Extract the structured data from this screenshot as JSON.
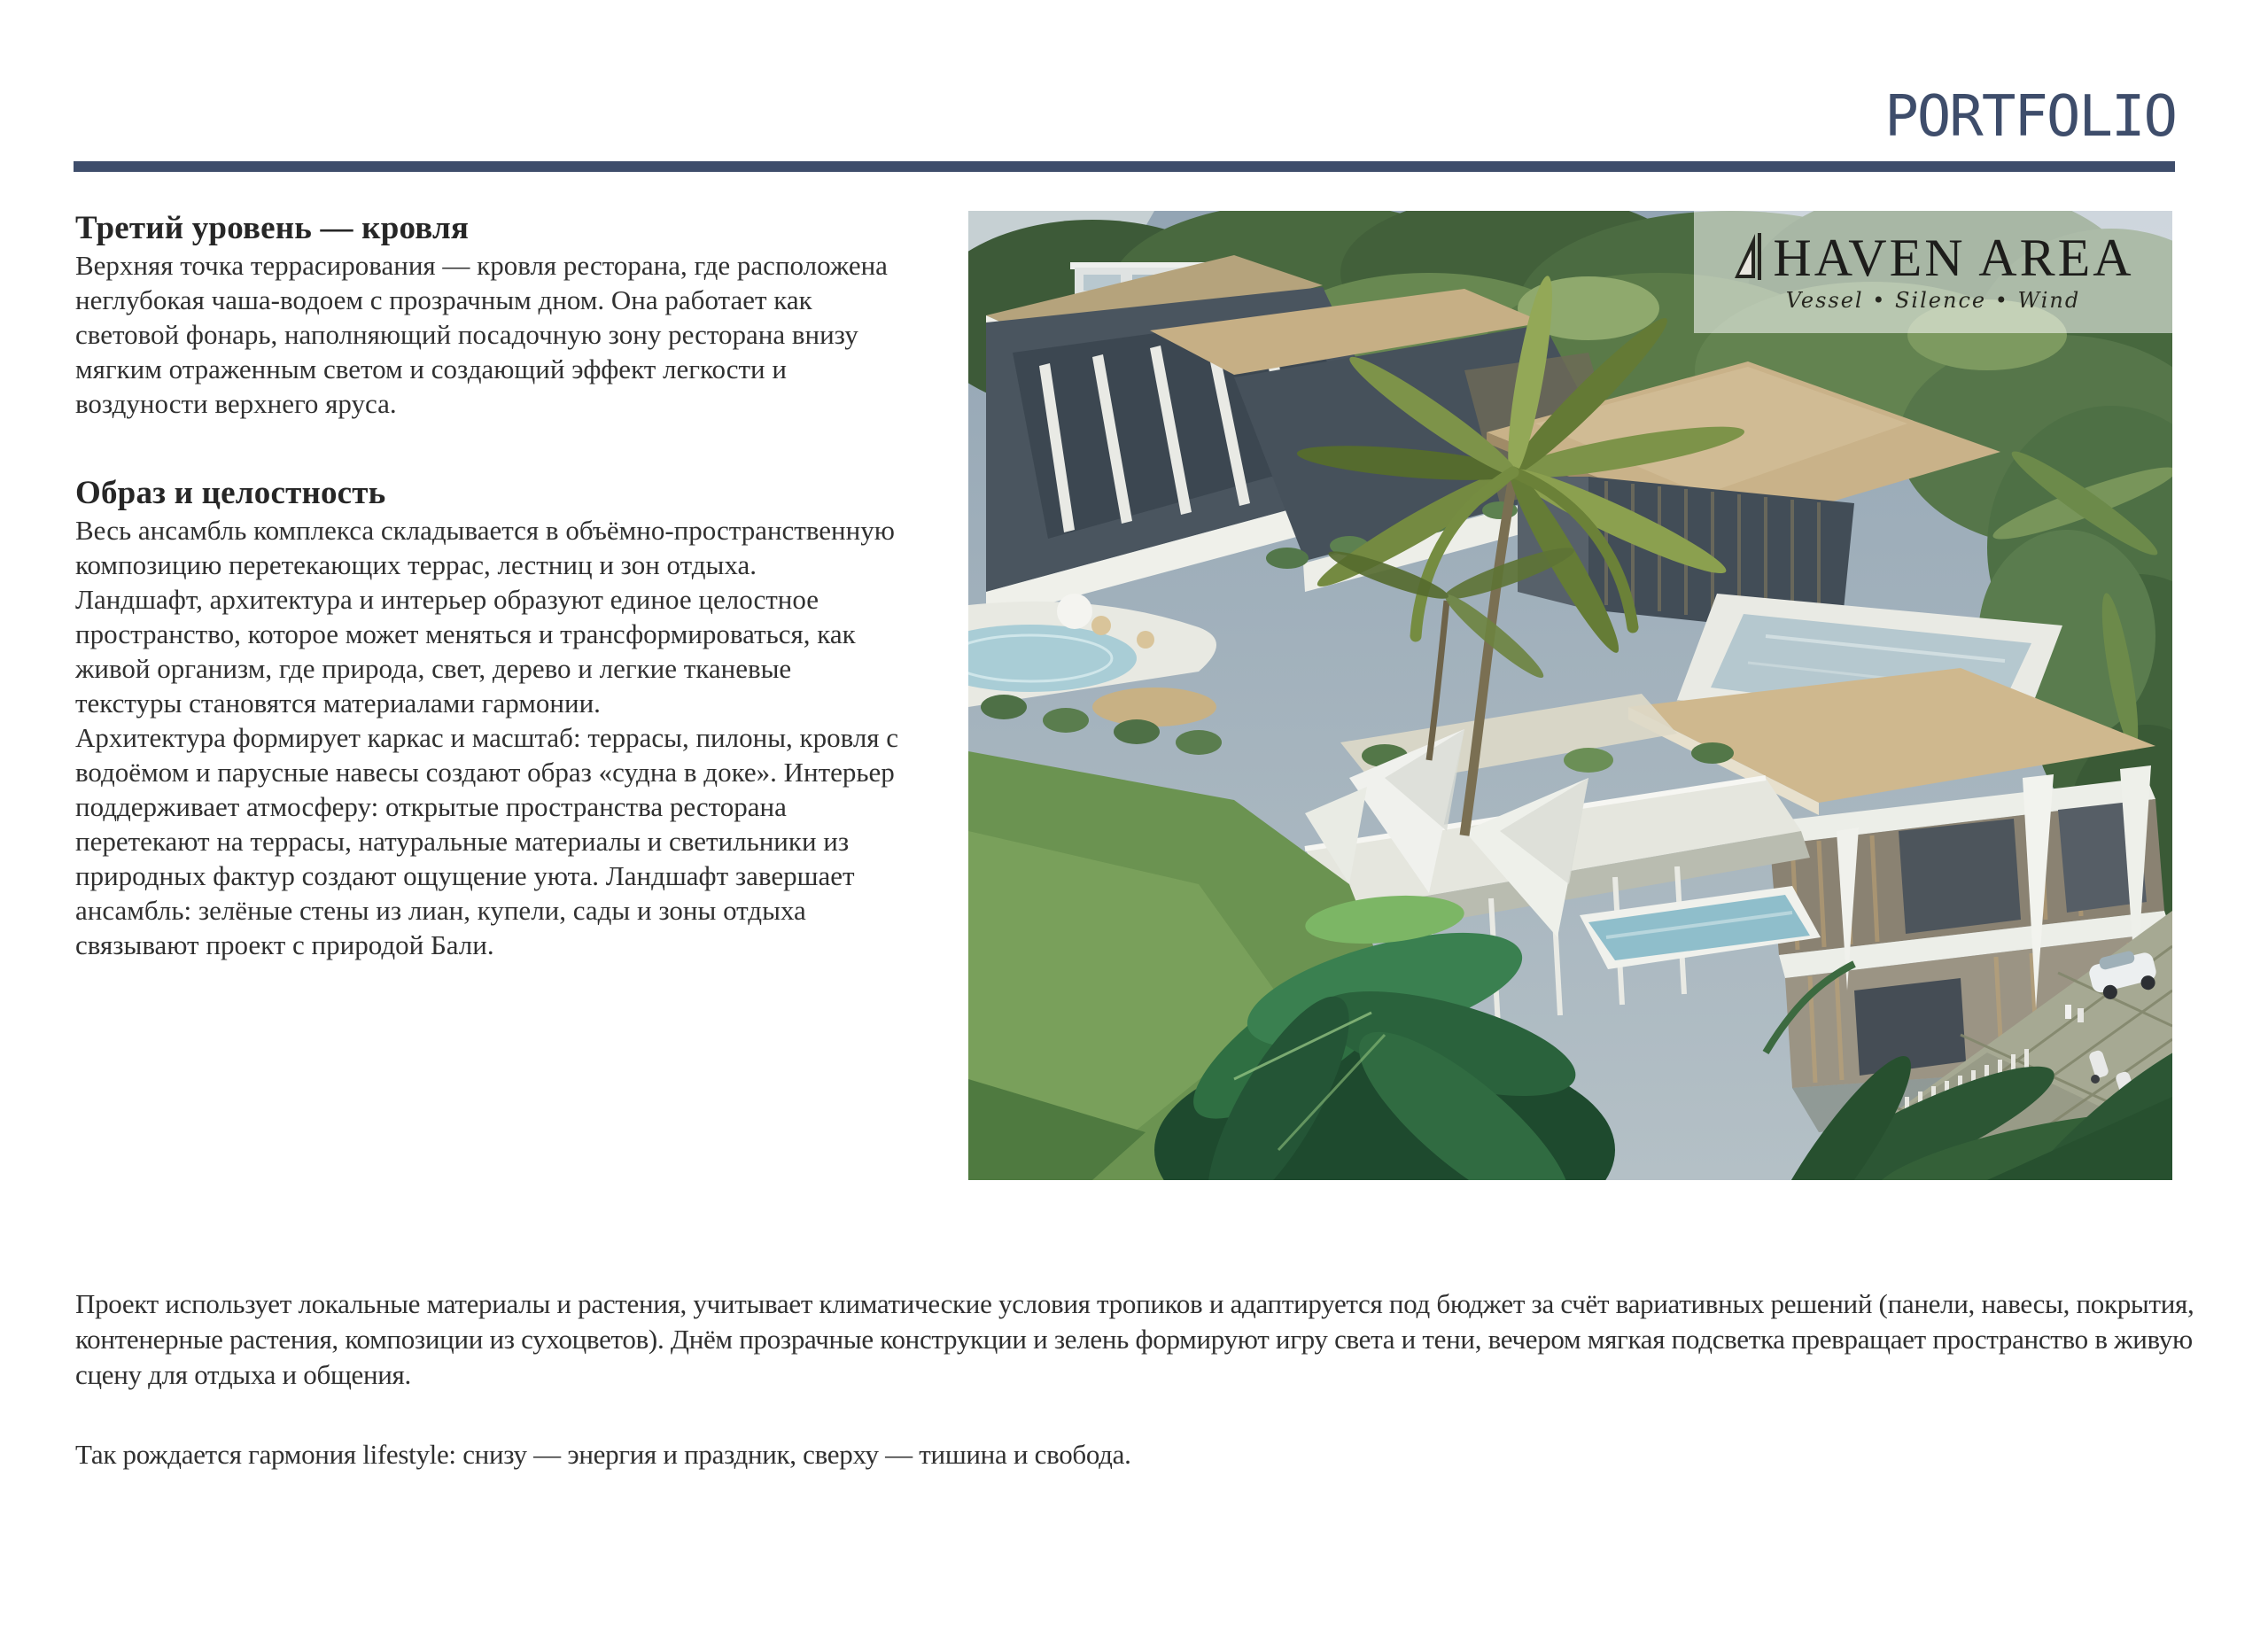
{
  "header": {
    "brand": "PORTFOLIO"
  },
  "colors": {
    "accent_navy": "#3E4D6B",
    "logo_text": "#1D1D1B",
    "body_text": "#303030"
  },
  "article": {
    "heading1": "Третий уровень — кровля",
    "para1": "Верхняя точка террасирования — кровля ресторана, где расположена неглубокая чаша-водоем с прозрачным дном. Она работает как световой фонарь, наполняющий посадочную зону ресторана внизу мягким отраженным светом и создающий эффект легкости и воздуности верхнего яруса.",
    "heading2": "Образ и целостность",
    "para2": "Весь ансамбль комплекса складывается в объёмно-пространственную композицию перетекающих террас, лестниц и зон отдыха.",
    "para3": "Ландшафт, архитектура и интерьер образуют единое целостное пространство, которое может меняться и трансформироваться, как живой организм, где природа, свет, дерево и легкие тканевые текстуры становятся материалами гармонии.",
    "para4": "Архитектура формирует каркас и масштаб: террасы, пилоны, кровля с водоёмом и парусные навесы создают образ «судна в доке». Интерьер поддерживает атмосферу: открытые пространства ресторана перетекают на террасы, натуральные материалы и светильники из природных фактур создают ощущение уюта. Ландшафт завершает ансамбль: зелёные стены из лиан, купели, сады и зоны отдыха связывают проект с природой Бали.",
    "para5": "Проект использует локальные материалы и растения, учитывает климатические условия тропиков и адаптируется под бюджет за счёт вариативных решений (панели, навесы, покрытия, контенерные растения, композиции из сухоцветов). Днём прозрачные конструкции и зелень формируют игру света и тени, вечером мягкая подсветка превращает пространство в живую сцену для отдыха и общения.",
    "para6": "Так рождается гармония lifestyle: снизу — энергия и праздник, сверху — тишина и свобода."
  },
  "logo": {
    "icon": "sail-icon",
    "name": "HAVEN AREA",
    "tagline": "Vessel • Silence • Wind"
  }
}
